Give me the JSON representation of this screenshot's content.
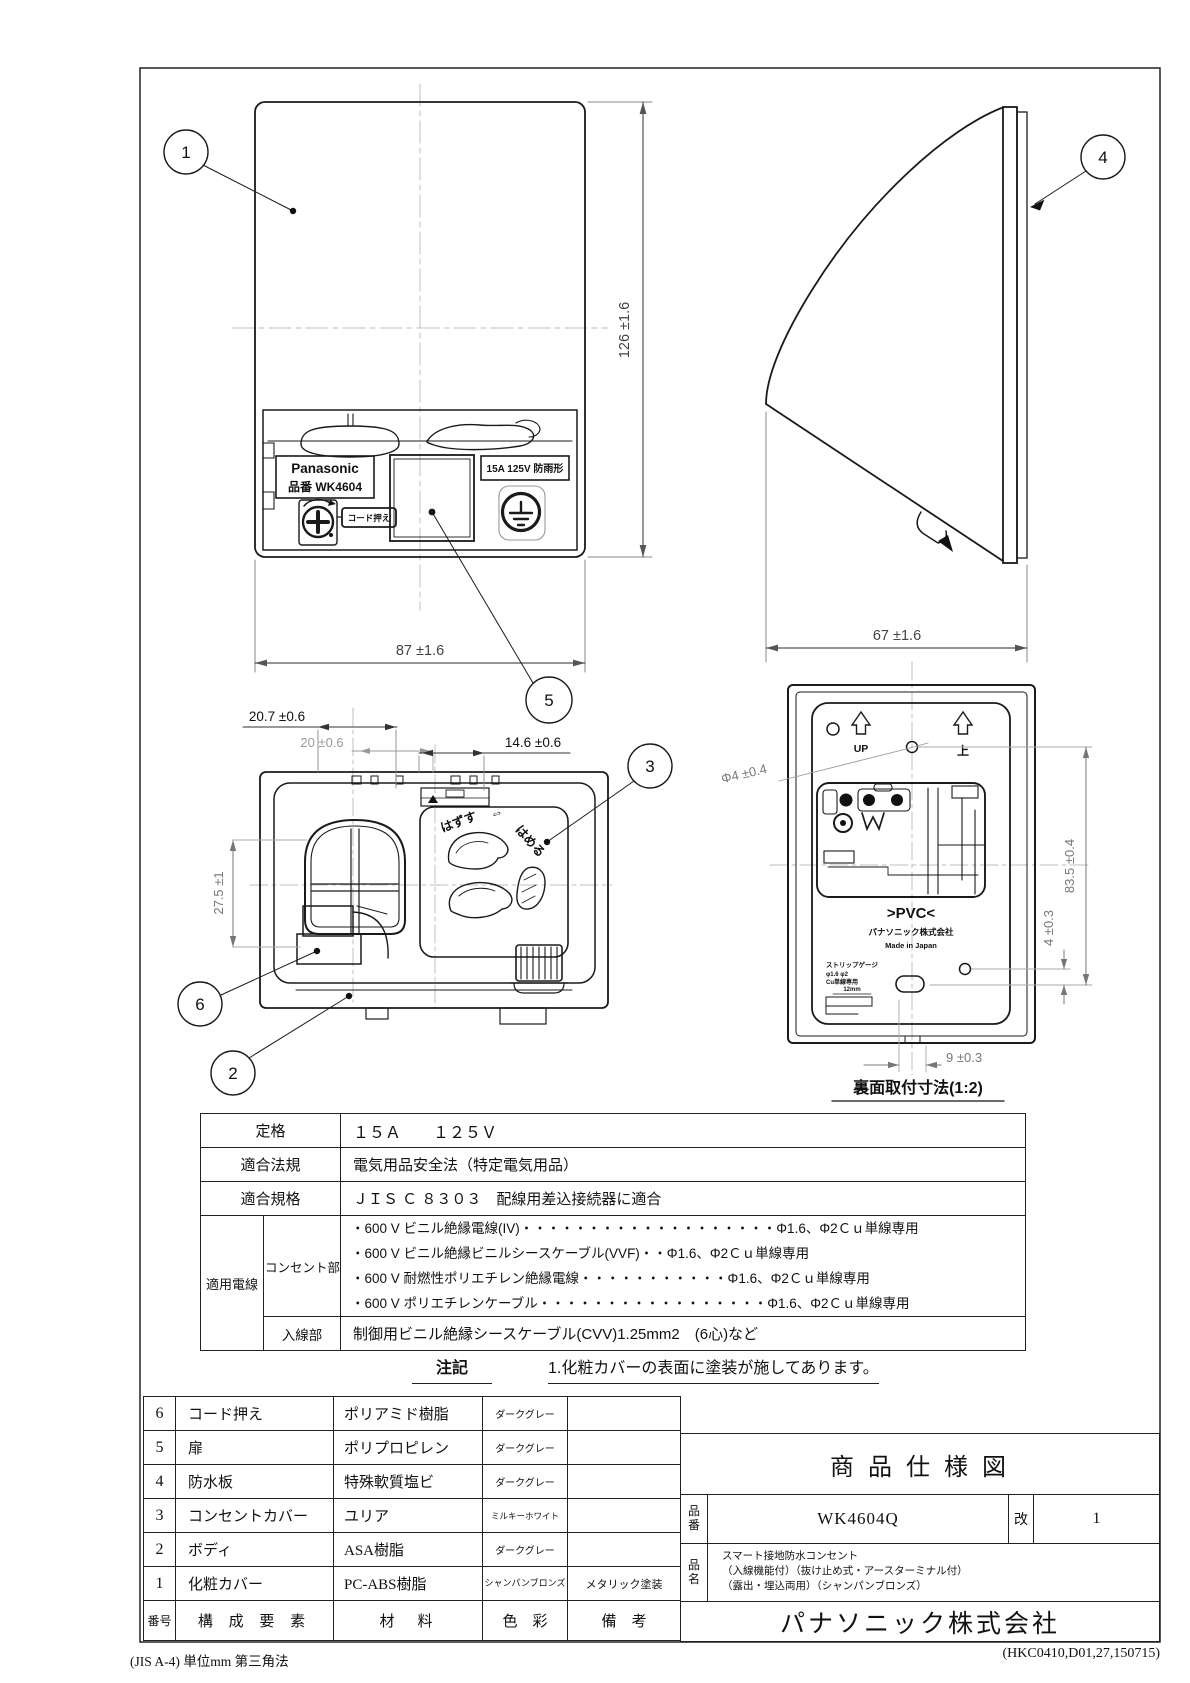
{
  "page": {
    "footer_left": "(JIS A-4)  単位mm  第三角法",
    "footer_right": "(HKC0410,D01,27,150715)"
  },
  "balloons": {
    "b1": "1",
    "b2": "2",
    "b3": "3",
    "b4": "4",
    "b5": "5",
    "b6": "6"
  },
  "front_view": {
    "brand": "Panasonic",
    "model": "品番 WK4604",
    "rating_label": "15A 125V 防雨形",
    "cord_tag": "コード押え",
    "dim_height": "126 ±1.6",
    "dim_width": "87 ±1.6"
  },
  "side_view": {
    "dim_depth": "67 ±1.6"
  },
  "open_view": {
    "dim_a": "20.7 ±0.6",
    "dim_b": "20 ±0.6",
    "dim_c": "14.6 ±0.6",
    "dim_d": "27.5 ±1",
    "remove": "はずす",
    "arrows": "⇔",
    "attach": "はめる"
  },
  "back_view": {
    "up_en": "UP",
    "up_ja": "上",
    "dim_hole": "Φ4 ±0.4",
    "pvc": ">PVC<",
    "maker": "パナソニック株式会社",
    "origin": "Made in Japan",
    "strip1": "ストリップゲージ",
    "strip2": "φ1.6 φ2",
    "strip3": "Cu単線専用",
    "gauge": "12mm",
    "dim_e": "83.5 ±0.4",
    "dim_f": "4 ±0.3",
    "dim_g": "9 ±0.3",
    "caption": "裏面取付寸法(1:2)"
  },
  "spec_table": {
    "rating_label": "定格",
    "rating_value": "１５Ａ　　１２５Ｖ",
    "law_label": "適合法規",
    "law_value": "電気用品安全法（特定電気用品）",
    "std_label": "適合規格",
    "std_value": "ＪＩＳ Ｃ ８３０３　配線用差込接続器に適合",
    "wire_label": "適用電線",
    "outlet_label": "コンセント部",
    "outlet_lines": [
      "・600 V ビニル絶縁電線(IV)・・・・・・・・・・・・・・・・・・・Φ1.6、Φ2Ｃｕ単線専用",
      "・600 V ビニル絶縁ビニルシースケーブル(VVF)・・Φ1.6、Φ2Ｃｕ単線専用",
      "・600 V 耐燃性ポリエチレン絶縁電線・・・・・・・・・・・Φ1.6、Φ2Ｃｕ単線専用",
      "・600 V ポリエチレンケーブル・・・・・・・・・・・・・・・・・Φ1.6、Φ2Ｃｕ単線専用"
    ],
    "inlet_label": "入線部",
    "inlet_value": "制御用ビニル絶縁シースケーブル(CVV)1.25mm2　(6心)など"
  },
  "note": {
    "label": "注記",
    "text": "1.化粧カバーの表面に塗装が施してあります。"
  },
  "parts_table": {
    "headers": {
      "no": "番号",
      "name": "構 成 要 素",
      "material": "材　料",
      "color": "色　彩",
      "remark": "備　考"
    },
    "rows": [
      {
        "no": "6",
        "name": "コード押え",
        "material": "ポリアミド樹脂",
        "color": "ダークグレー",
        "remark": ""
      },
      {
        "no": "5",
        "name": "扉",
        "material": "ポリプロピレン",
        "color": "ダークグレー",
        "remark": ""
      },
      {
        "no": "4",
        "name": "防水板",
        "material": "特殊軟質塩ビ",
        "color": "ダークグレー",
        "remark": ""
      },
      {
        "no": "3",
        "name": "コンセントカバー",
        "material": "ユリア",
        "color": "ミルキーホワイト",
        "remark": ""
      },
      {
        "no": "2",
        "name": "ボディ",
        "material": "ASA樹脂",
        "color": "ダークグレー",
        "remark": ""
      },
      {
        "no": "1",
        "name": "化粧カバー",
        "material": "PC-ABS樹脂",
        "color": "シャンパンブロンズ",
        "remark": "メタリック塗装"
      }
    ]
  },
  "title_block": {
    "title": "商 品 仕 様 図",
    "pn_label": "品番",
    "pn_value": "WK4604Q",
    "rev_label": "改",
    "rev_value": "1",
    "name_label": "品名",
    "name_line1": "スマート接地防水コンセント",
    "name_line2": "（入線機能付）（抜け止め式・アースターミナル付）",
    "name_line3": "（露出・埋込両用）（シャンパンブロンズ）",
    "company": "パナソニック株式会社"
  }
}
